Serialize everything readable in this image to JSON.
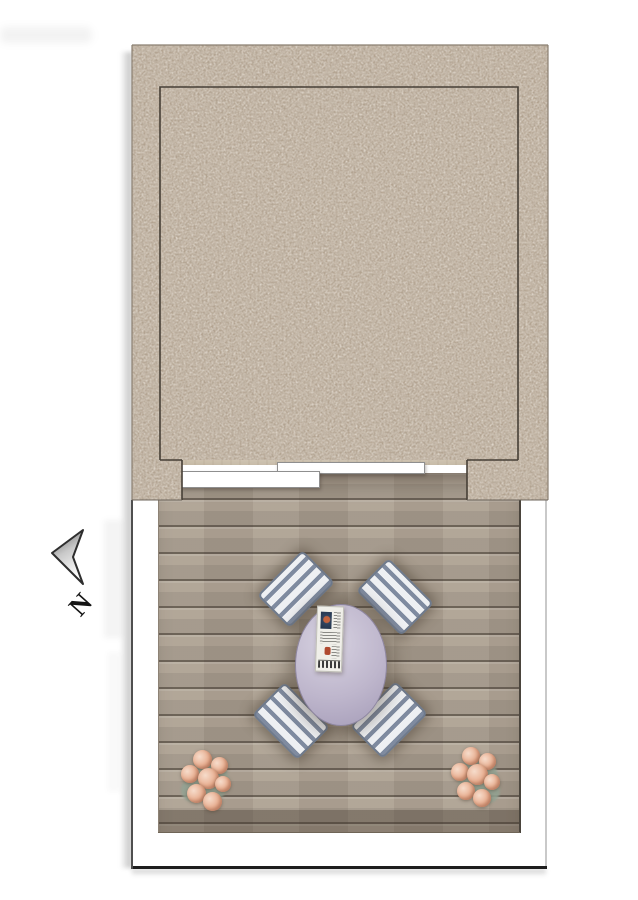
{
  "compass": {
    "label": "N"
  },
  "plan": {
    "type": "floor-plan",
    "upper_room": {
      "stairs": "u-shaped-winder-staircase",
      "furniture": [
        "white-armchair",
        "desk",
        "green-desk-lamp",
        "monitor",
        "office-chair"
      ],
      "annotations": [
        "stair-direction-curved-arrow",
        "walk-direction-arrow",
        "sliding-door-two-panels"
      ]
    },
    "terrace": {
      "furniture": [
        "oval-dining-table",
        "newspaper",
        "striped-chair-nw",
        "striped-chair-ne",
        "striped-chair-sw",
        "striped-chair-se",
        "flower-pot-left",
        "flower-pot-right"
      ]
    }
  },
  "colors": {
    "wall": "#b3a390",
    "room_floor": "#f2e8d5",
    "stair_outline": "#2f2a24",
    "deck_plank": "#aea293",
    "deck_gap": "#40382e",
    "frame": "#ffffff",
    "desk": "#b9b1c8",
    "table": "#beb6cc",
    "chair_stripe_dark": "#7f8ba0",
    "chair_stripe_light": "#eef0f3",
    "lamp_green": "#27a22f",
    "arrow": "#111111",
    "flower": "#e8ae90"
  }
}
